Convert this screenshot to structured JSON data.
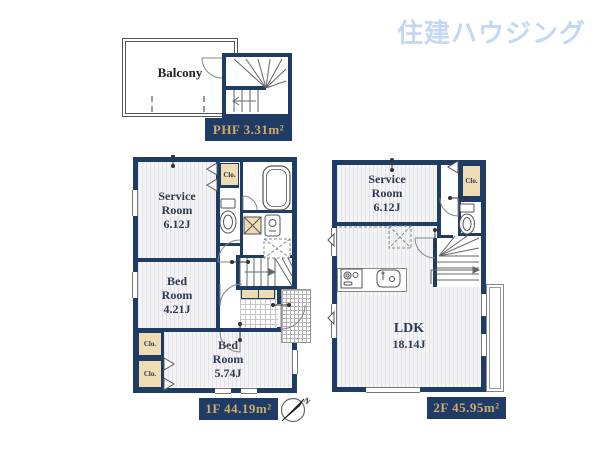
{
  "logo": {
    "text": "住建ハウジング"
  },
  "colors": {
    "wall": "#1e3c64",
    "gold": "#cfab6d",
    "tan": "#eddcb4",
    "logo": "#c4d7f3"
  },
  "phf": {
    "balcony_label": "Balcony",
    "area_label": "PHF 3.31m²"
  },
  "f1": {
    "service": {
      "l1": "Service",
      "l2": "Room",
      "l3": "6.12J"
    },
    "bed1": {
      "l1": "Bed",
      "l2": "Room",
      "l3": "4.21J"
    },
    "bed2": {
      "l1": "Bed",
      "l2": "Room",
      "l3": "5.74J"
    },
    "closet_label": "Clo.",
    "area_label": "1F 44.19m²"
  },
  "f2": {
    "service": {
      "l1": "Service",
      "l2": "Room",
      "l3": "6.12J"
    },
    "ldk": {
      "l1": "LDK",
      "l2": "18.14J"
    },
    "closet_label": "Clo.",
    "area_label": "2F 45.95m²"
  },
  "compass": {
    "north": "N"
  }
}
